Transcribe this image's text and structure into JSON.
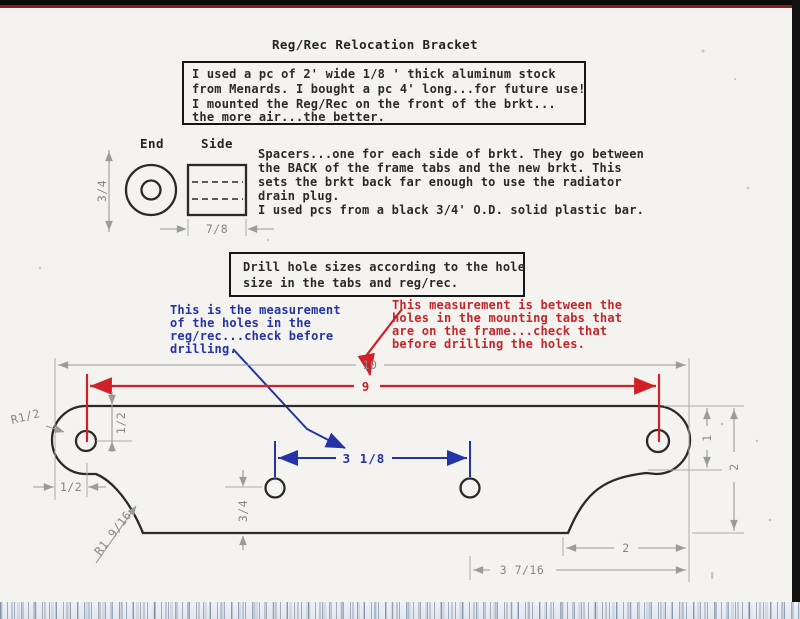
{
  "page": {
    "title": "Reg/Rec Relocation Bracket"
  },
  "info_box": {
    "lines": [
      "I used a pc of 2' wide 1/8 ' thick aluminum stock",
      "from Menards. I bought a pc 4' long...for future use!",
      "I mounted the Reg/Rec on the front of the brkt...",
      "the more air...the better."
    ]
  },
  "spacer": {
    "end_label": "End",
    "side_label": "Side",
    "od_dim": "3/4",
    "length_dim": "7/8",
    "lines": [
      "Spacers...one for each side of brkt. They go between",
      "the BACK of the frame tabs and the new brkt. This",
      "sets the brkt back far enough to use the radiator",
      "drain plug.",
      "I used pcs from a black 3/4' O.D. solid plastic bar."
    ]
  },
  "drill_box": {
    "lines": [
      "Drill hole sizes according to the hole",
      "size in the tabs and reg/rec."
    ]
  },
  "blue_note": {
    "color": "#2433a8",
    "lines": [
      "This is the measurement",
      "of the holes in the",
      "reg/rec...check before",
      "drilling."
    ]
  },
  "red_note": {
    "color": "#c5252b",
    "lines": [
      "This measurement is between the",
      "holes in the mounting tabs that",
      "are on the frame...check that",
      "before drilling the holes."
    ]
  },
  "dims": {
    "overall_width": "10",
    "frame_hole_span": "9",
    "regrec_hole_span": "3 1/8",
    "tab_hole_top_offset": "1/2",
    "tab_hole_side_offset": "1/2",
    "tab_end_radius": "R1/2",
    "bend_radius": "R1 9/16",
    "center_hole_bottom_offset": "3/4",
    "tab_height": "1",
    "plate_height": "2",
    "bottom_right_offset": "2",
    "hole_to_edge": "3 7/16"
  },
  "colors": {
    "paper": "#f4f3ef",
    "outline": "#2a2a2a",
    "dimension_gray": "#9b9b9b",
    "accent_red": "#cf2127",
    "accent_blue": "#2433a8",
    "scan_edge_red": "#8e1c1c",
    "scan_edge_black": "#0c0c0c"
  }
}
